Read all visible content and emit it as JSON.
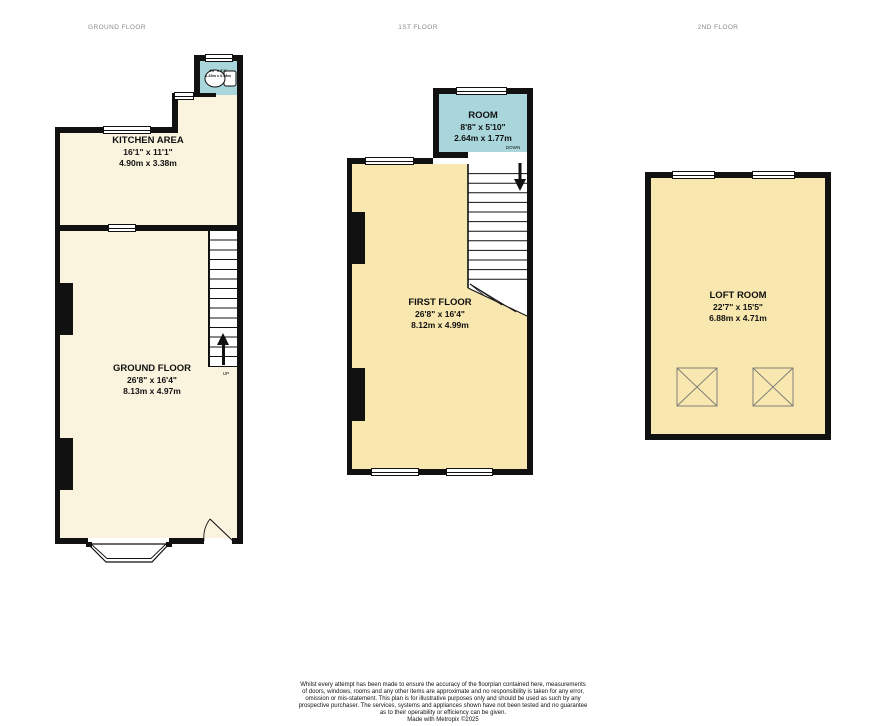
{
  "headers": {
    "ground": "GROUND FLOOR",
    "first": "1ST FLOOR",
    "second": "2ND FLOOR"
  },
  "rooms": {
    "wc": {
      "dims_ft": "4'0\" x 3'2\"",
      "dims_m": "1.23m x 0.98m"
    },
    "kitchen": {
      "name": "KITCHEN AREA",
      "dims_ft": "16'1\" x 11'1\"",
      "dims_m": "4.90m x 3.38m"
    },
    "ground_floor": {
      "name": "GROUND FLOOR",
      "dims_ft": "26'8\" x 16'4\"",
      "dims_m": "8.13m x 4.97m"
    },
    "room": {
      "name": "ROOM",
      "dims_ft": "8'8\" x 5'10\"",
      "dims_m": "2.64m x 1.77m"
    },
    "first_floor": {
      "name": "FIRST FLOOR",
      "dims_ft": "26'8\" x 16'4\"",
      "dims_m": "8.12m x 4.99m"
    },
    "loft": {
      "name": "LOFT ROOM",
      "dims_ft": "22'7\" x 15'5\"",
      "dims_m": "6.88m x 4.71m"
    }
  },
  "stairs": {
    "up": "UP",
    "down": "DOWN"
  },
  "icons": {
    "toilet_icon": "toilet bowl and cistern symbol",
    "up_arrow_icon": "arrow pointing up the stairs",
    "down_arrow_icon": "arrow pointing down the stairs",
    "skylight_icon": "crossed-box roof window symbol"
  },
  "colors": {
    "wall": "#111111",
    "ground_fill": "#FAF3DE",
    "upper_fill": "#F8E7AE",
    "small_room_fill": "#A8D6DB",
    "header_text": "#8a8a8a"
  },
  "footer": {
    "disclaimer": "Whilst every attempt has been made to ensure the accuracy of the floorplan contained here, measurements\nof doors, windows, rooms and any other items are approximate and no responsibility is taken for any error,\nomission or mis-statement. This plan is for illustrative purposes only and should be used as such by any\nprospective purchaser. The services, systems and appliances shown have not been tested and no guarantee\nas to their operability or efficiency can be given.",
    "credit": "Made with Metropix ©2025"
  }
}
